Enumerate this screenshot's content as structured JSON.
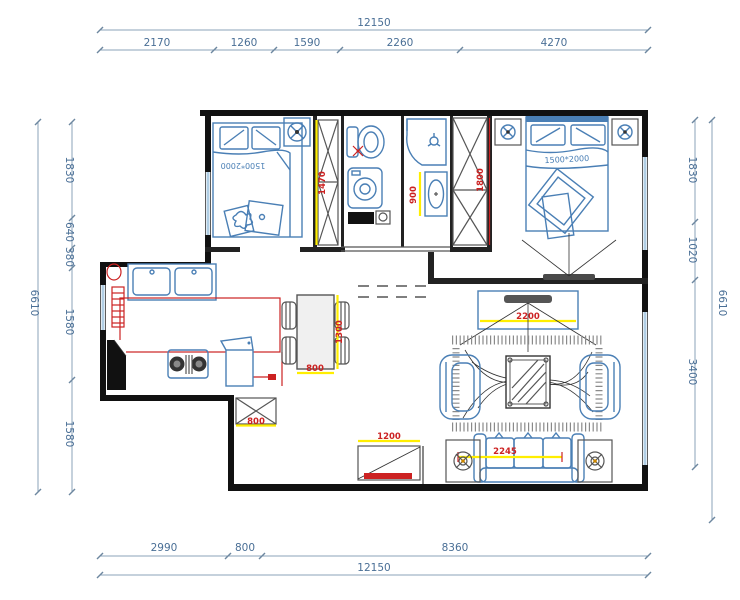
{
  "plan": {
    "dimensions": {
      "top": {
        "total": "12150",
        "segments": [
          "2170",
          "1260",
          "1590",
          "2260",
          "4270"
        ]
      },
      "bottom": {
        "total": "12150",
        "segments": [
          "2990",
          "800",
          "8360"
        ]
      },
      "left": {
        "total": "6610",
        "segments": [
          "1830",
          "640",
          "380",
          "1580",
          "1580"
        ]
      },
      "right": {
        "total": "6610",
        "segments": [
          "1830",
          "1020",
          "3400"
        ]
      }
    },
    "interior_dimensions": {
      "wardrobe_small": "1470",
      "wardrobe_master": "1800",
      "vanity": "900",
      "tv_wall": "2200",
      "sofa": "2245",
      "entry_door": "1200",
      "duct": "800",
      "dining_width": "800",
      "dining_length": "1300"
    },
    "furniture_labels": {
      "small_bed": "1500*2000",
      "master_bed": "1500*2000"
    },
    "colors": {
      "wall": "#111111",
      "furniture_blue": "#4a7fb5",
      "dimension_text": "#4a6f96",
      "highlight_yellow": "#ffee00",
      "accent_red": "#cc2222",
      "window_blue": "#8fb8d8"
    }
  }
}
